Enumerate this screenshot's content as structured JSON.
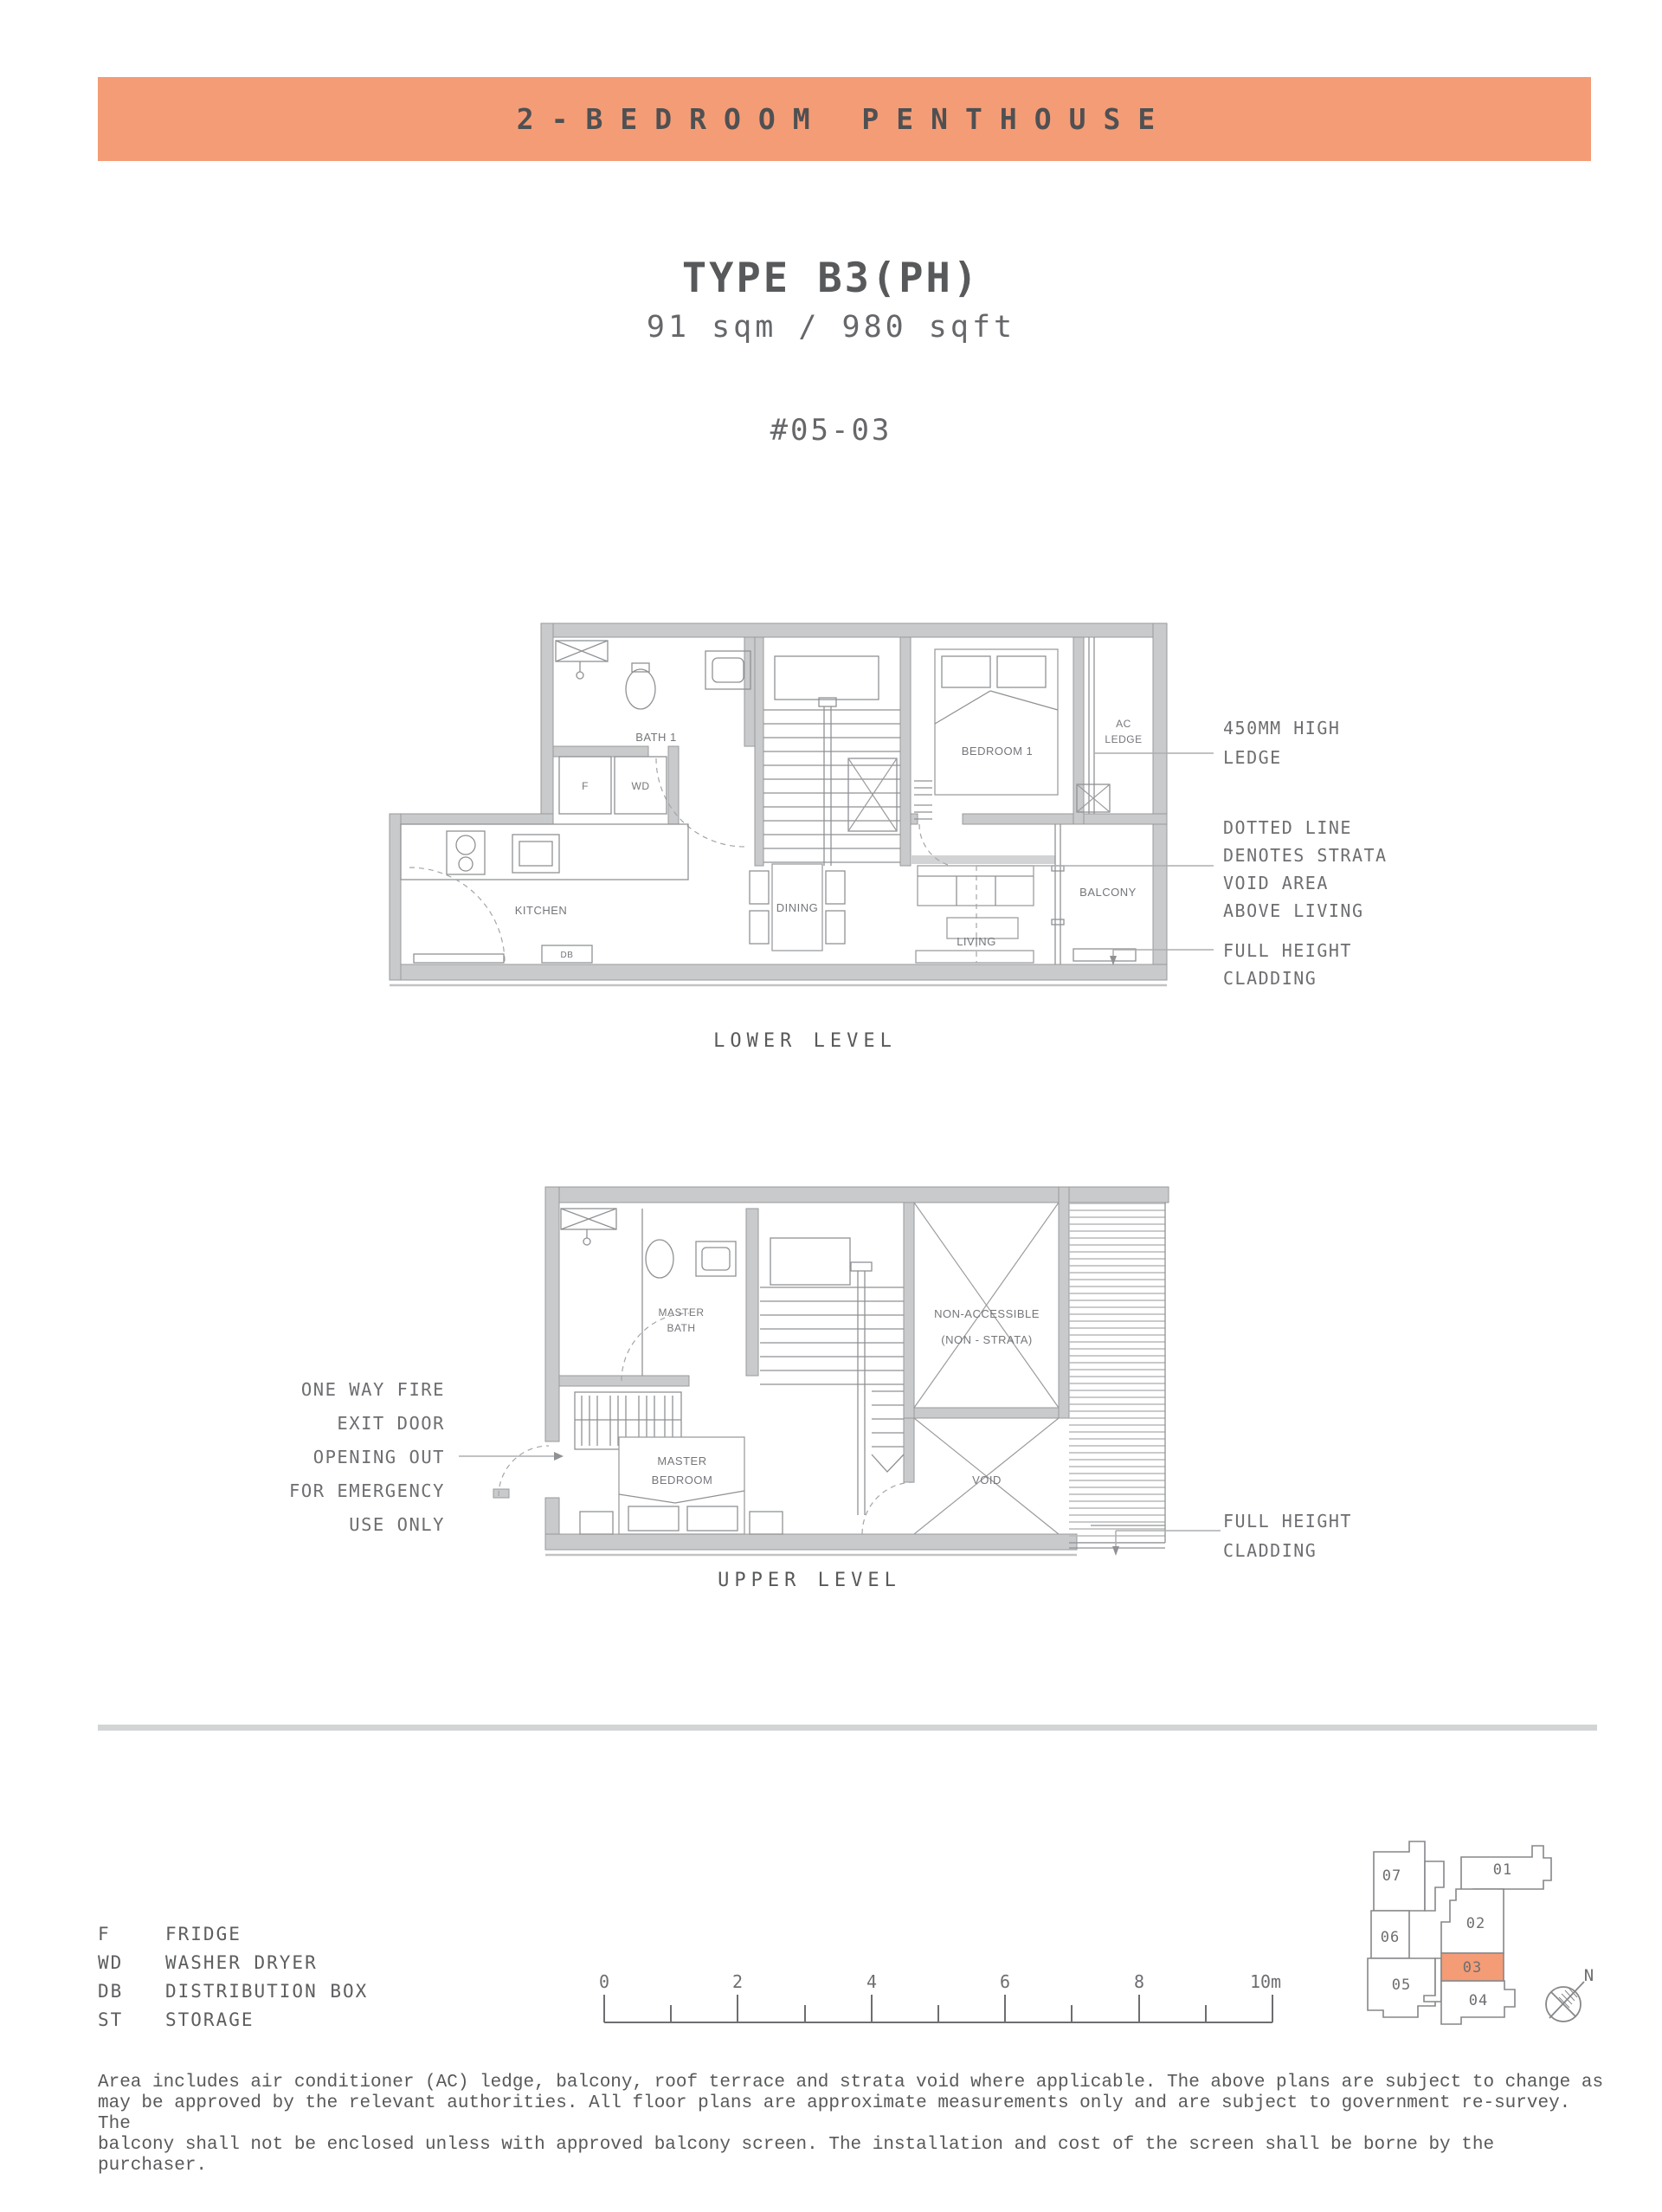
{
  "colors": {
    "accent": "#F49C76",
    "banner_text": "#4F5052",
    "heading": "#58595B",
    "body_text": "#6D6E71",
    "wall_fill": "#C9CACB",
    "wall_line": "#97999C"
  },
  "banner": {
    "title": "2-BEDROOM PENTHOUSE"
  },
  "header": {
    "type_label": "TYPE B3(PH)",
    "area": "91 sqm / 980 sqft",
    "unit_number": "#05-03"
  },
  "lower_level": {
    "caption": "LOWER LEVEL",
    "rooms": {
      "bath": "BATH 1",
      "fridge": "F",
      "washer_dryer": "WD",
      "bedroom": "BEDROOM 1",
      "ac_line1": "AC",
      "ac_line2": "LEDGE",
      "kitchen": "KITCHEN",
      "dining": "DINING",
      "living": "LIVING",
      "balcony": "BALCONY",
      "distribution_box": "DB"
    },
    "annotations": {
      "ledge_line1": "450MM HIGH",
      "ledge_line2": "LEDGE",
      "strata_line1": "DOTTED LINE",
      "strata_line2": "DENOTES STRATA",
      "strata_line3": "VOID AREA",
      "strata_line4": "ABOVE LIVING",
      "cladding_line1": "FULL HEIGHT",
      "cladding_line2": "CLADDING"
    }
  },
  "upper_level": {
    "caption": "UPPER LEVEL",
    "rooms": {
      "master_bath_line1": "MASTER",
      "master_bath_line2": "BATH",
      "non_accessible_line1": "NON-ACCESSIBLE",
      "non_accessible_line2": "(NON - STRATA)",
      "master_bedroom_line1": "MASTER",
      "master_bedroom_line2": "BEDROOM",
      "void": "VOID"
    },
    "annotations": {
      "fire_exit_line1": "ONE WAY FIRE",
      "fire_exit_line2": "EXIT DOOR",
      "fire_exit_line3": "OPENING OUT",
      "fire_exit_line4": "FOR EMERGENCY",
      "fire_exit_line5": "USE ONLY",
      "cladding_line1": "FULL HEIGHT",
      "cladding_line2": "CLADDING"
    }
  },
  "legend": {
    "items": [
      {
        "code": "F",
        "label": "FRIDGE"
      },
      {
        "code": "WD",
        "label": "WASHER DRYER"
      },
      {
        "code": "DB",
        "label": "DISTRIBUTION BOX"
      },
      {
        "code": "ST",
        "label": "STORAGE"
      }
    ]
  },
  "scale_bar": {
    "labels": [
      "0",
      "2",
      "4",
      "6",
      "8",
      "10m"
    ]
  },
  "key_plan": {
    "units": {
      "u01": "01",
      "u02": "02",
      "u03": "03",
      "u04": "04",
      "u05": "05",
      "u06": "06",
      "u07": "07"
    },
    "highlighted_unit": "03",
    "north_label": "N"
  },
  "disclaimer": {
    "lines": [
      "Area includes air conditioner (AC) ledge, balcony, roof terrace and strata void where applicable. The above plans are subject to change as",
      "may be approved by the relevant authorities. All floor plans are approximate measurements only and are subject to government re-survey. The",
      "balcony shall not be enclosed unless with approved balcony screen. The installation and cost of the screen shall be borne by the purchaser."
    ]
  }
}
